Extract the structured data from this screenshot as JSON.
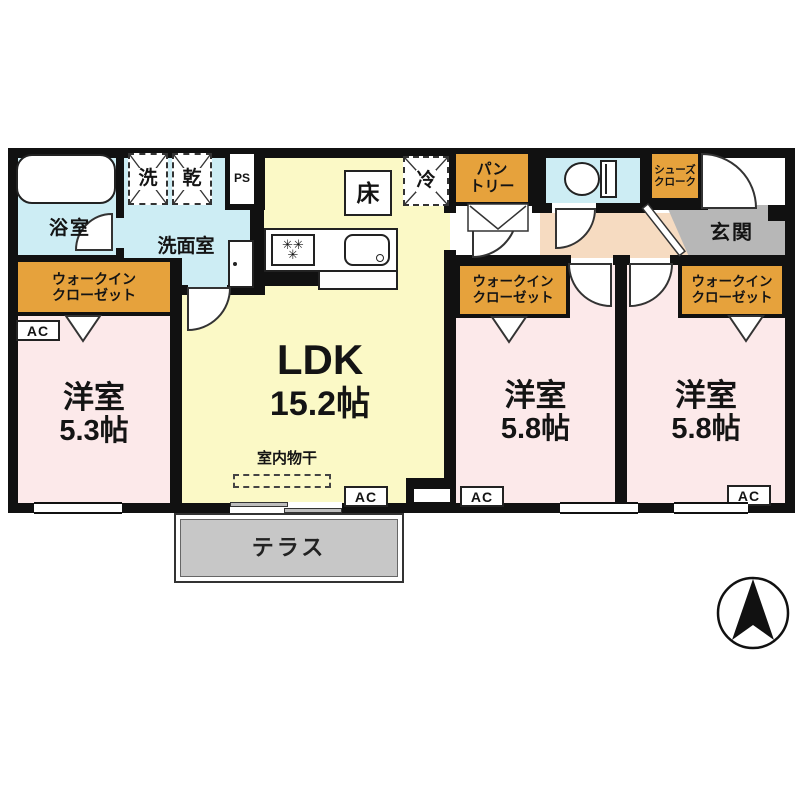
{
  "rooms": {
    "bath": "浴室",
    "washroom": "洗面室",
    "washer": "洗",
    "dryer": "乾",
    "pipe_space": "PS",
    "ldk_name": "LDK",
    "ldk_size": "15.2帖",
    "floor_hatch": "床",
    "fridge": "冷",
    "pantry": "パン\nトリー",
    "shoe_closet": "シューズ\nクローク",
    "entrance": "玄関",
    "wic": "ウォークイン\nクローゼット",
    "bedroom_name": "洋室",
    "bedroom_left_size": "5.3帖",
    "bedroom_size": "5.8帖",
    "ac": "AC",
    "indoor_drying": "室内物干",
    "terrace": "テラス"
  },
  "colors": {
    "wet": "#cdedf4",
    "ldk": "#fbf9c6",
    "bedroom": "#fce9ea",
    "closet": "#e6a23c",
    "hall": "#f6dbc1",
    "entrance": "#b7b7b7",
    "terrace": "#c7c7c7",
    "wall": "#111111"
  }
}
